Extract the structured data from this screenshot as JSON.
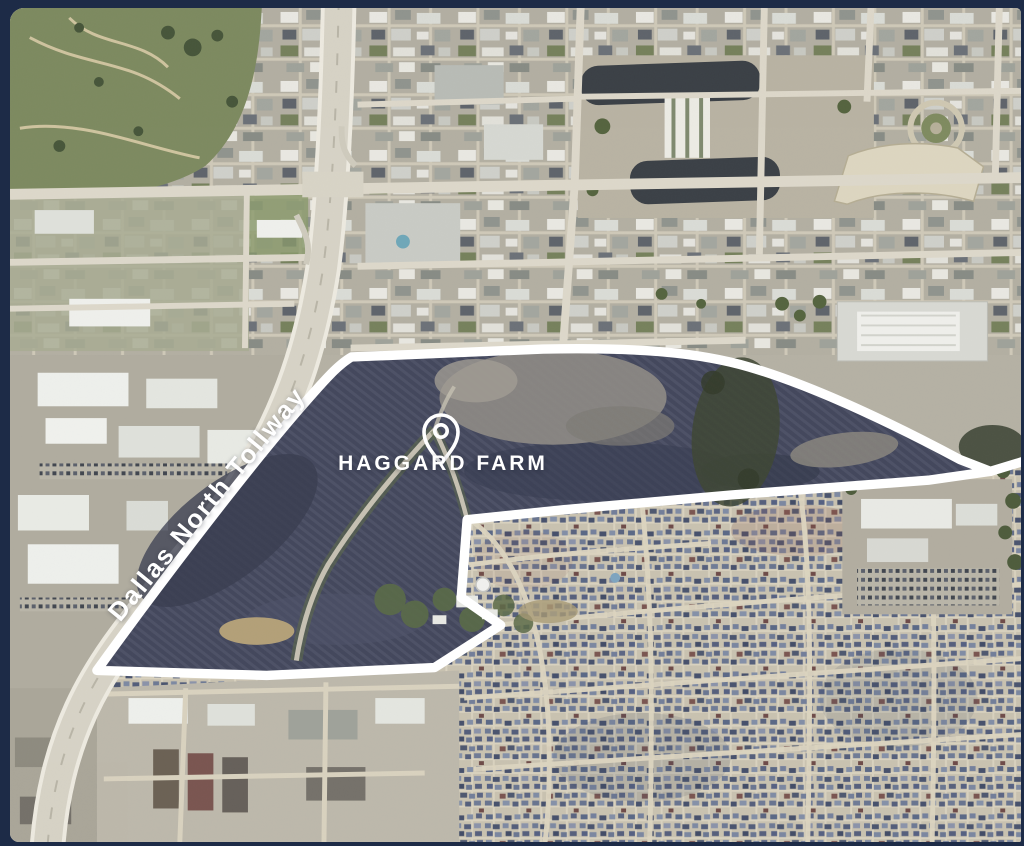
{
  "frame": {
    "background_color": "#1d2b47"
  },
  "map": {
    "type": "aerial-satellite-photo",
    "labels": {
      "site": "HAGGARD FARM",
      "road": "Dallas North Tollway"
    },
    "icons": {
      "pin": "location-pin-icon"
    },
    "colors": {
      "boundary_outline": "#ffffff",
      "farm_field": "#43475c",
      "label_text": "#ffffff",
      "land_base": "#b5b1a4"
    },
    "annotations": [
      {
        "name": "site-boundary",
        "style": "thick-white-outline",
        "shape": "irregular-polygon"
      },
      {
        "name": "site-label",
        "text": "HAGGARD FARM"
      },
      {
        "name": "road-label",
        "text": "Dallas North Tollway",
        "rotation_deg": -50.5
      }
    ]
  }
}
